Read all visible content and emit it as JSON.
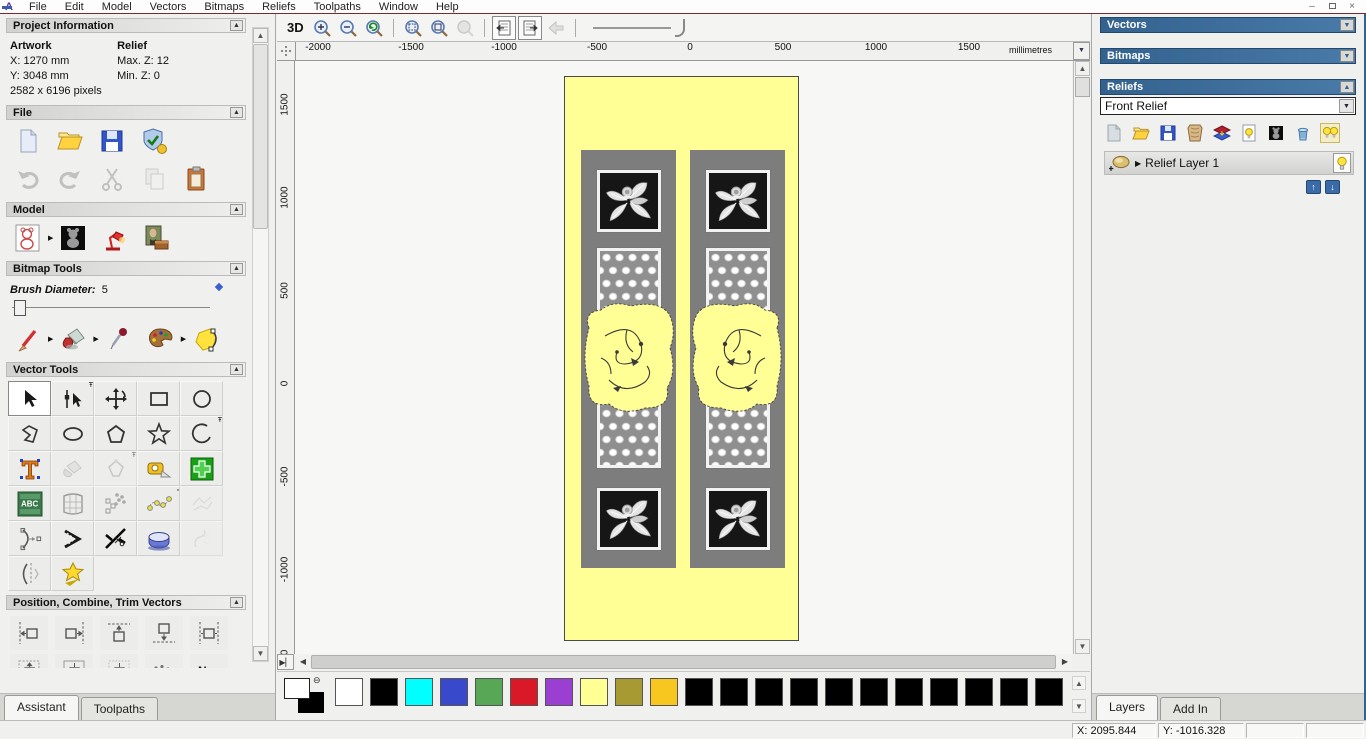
{
  "menu": {
    "items": [
      "File",
      "Edit",
      "Model",
      "Vectors",
      "Bitmaps",
      "Reliefs",
      "Toolpaths",
      "Window",
      "Help"
    ]
  },
  "assistant": {
    "project_information": {
      "title": "Project Information",
      "artwork_heading": "Artwork",
      "relief_heading": "Relief",
      "artwork_x": "X: 1270 mm",
      "artwork_y": "Y: 3048 mm",
      "artwork_pixels": "2582 x 6196 pixels",
      "relief_max_z": "Max. Z: 12",
      "relief_min_z": "Min. Z: 0"
    },
    "file_title": "File",
    "model_title": "Model",
    "bitmap_tools_title": "Bitmap Tools",
    "brush_diameter": {
      "label": "Brush Diameter:",
      "value": "5"
    },
    "vector_tools_title": "Vector Tools",
    "position_title": "Position, Combine, Trim Vectors",
    "nesting_label": "Nes",
    "tabs": {
      "assistant": "Assistant",
      "toolpaths": "Toolpaths"
    }
  },
  "viewbar": {
    "three_d_label": "3D"
  },
  "ruler": {
    "units": "millimetres",
    "h_labels": [
      "-2000",
      "-1500",
      "-1000",
      "-500",
      "0",
      "500",
      "1000",
      "1500"
    ],
    "v_labels": [
      "1500",
      "1000",
      "500",
      "0",
      "-500",
      "-1000",
      "-1500"
    ]
  },
  "right_panel": {
    "vectors_title": "Vectors",
    "bitmaps_title": "Bitmaps",
    "reliefs_title": "Reliefs",
    "relief_selector_value": "Front Relief",
    "relief_layer_name": "Relief Layer 1",
    "tabs": {
      "layers": "Layers",
      "add_in": "Add In"
    }
  },
  "status": {
    "x_coord": "X: 2095.844",
    "y_coord": "Y: -1016.328"
  },
  "palette": {
    "swatches": [
      "#ffffff",
      "#000000",
      "#00ffff",
      "#3949cc",
      "#57a757",
      "#d91828",
      "#9b3ed2",
      "#ffff94",
      "#a79a33",
      "#f7c71f",
      "#000000",
      "#000000",
      "#000000",
      "#000000",
      "#000000",
      "#000000",
      "#000000",
      "#000000",
      "#000000",
      "#000000",
      "#000000"
    ]
  },
  "colors": {
    "header_blue": "#33628f",
    "door_yellow": "#ffff96",
    "strip_gray": "#7d7d7d"
  }
}
